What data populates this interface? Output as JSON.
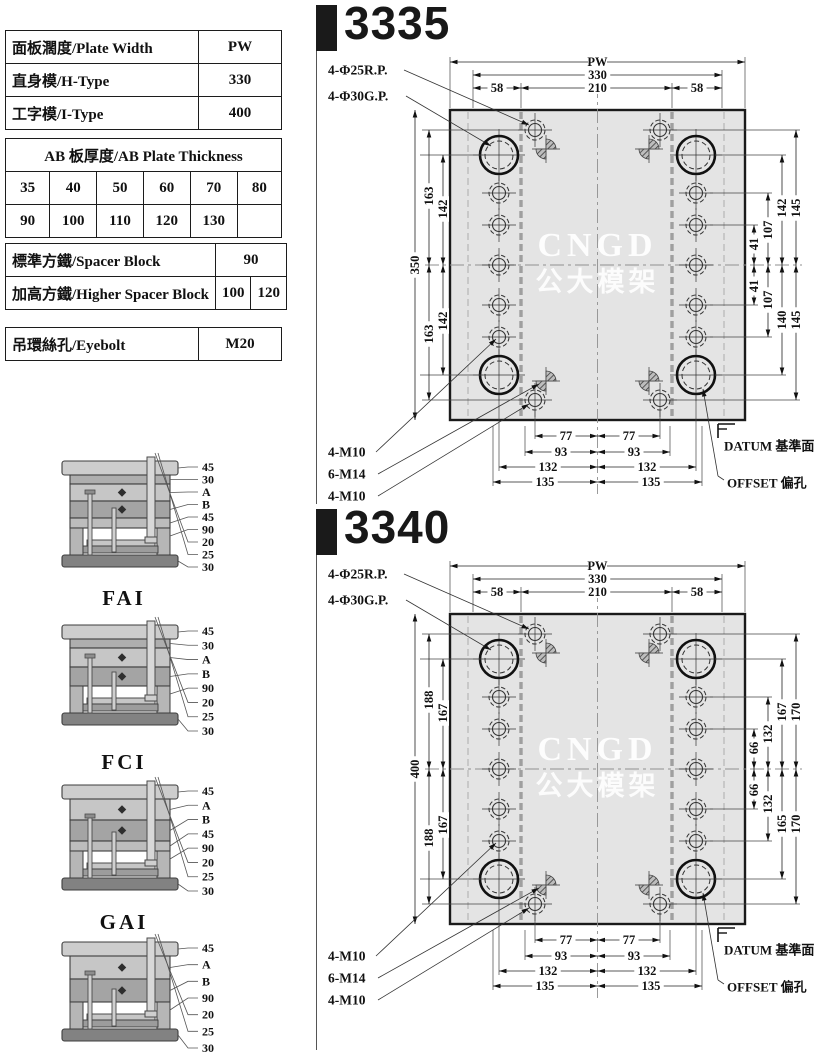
{
  "tables": {
    "plate_width": {
      "rows": [
        {
          "label": "面板濶度/Plate Width",
          "value": "PW"
        },
        {
          "label": "直身模/H-Type",
          "value": "330"
        },
        {
          "label": "工字模/I-Type",
          "value": "400"
        }
      ]
    },
    "ab_plate": {
      "header": "AB 板厚度/AB Plate Thickness",
      "rows": [
        [
          "35",
          "40",
          "50",
          "60",
          "70",
          "80"
        ],
        [
          "90",
          "100",
          "110",
          "120",
          "130",
          ""
        ]
      ]
    },
    "spacer": {
      "rows": [
        {
          "label": "標準方鐵/Spacer Block",
          "values": [
            "90"
          ]
        },
        {
          "label": "加高方鐵/Higher Spacer Block",
          "values": [
            "100",
            "120"
          ]
        }
      ]
    },
    "eyebolt": {
      "label": "吊環絲孔/Eyebolt",
      "value": "M20"
    }
  },
  "side_views": [
    {
      "name": "FAI",
      "labels": [
        "45",
        "30",
        "A",
        "B",
        "45",
        "90",
        "20",
        "25",
        "30"
      ]
    },
    {
      "name": "FCI",
      "labels": [
        "45",
        "30",
        "A",
        "B",
        "90",
        "20",
        "25",
        "30"
      ]
    },
    {
      "name": "GAI",
      "labels": [
        "45",
        "A",
        "B",
        "45",
        "90",
        "20",
        "25",
        "30"
      ]
    },
    {
      "name": "GCI",
      "labels": [
        "45",
        "A",
        "B",
        "90",
        "20",
        "25",
        "30"
      ]
    }
  ],
  "drawings": [
    {
      "model": "3335",
      "top": {
        "pw": "PW",
        "width": "330",
        "side_left": "58",
        "center": "210",
        "side_right": "58"
      },
      "left": {
        "overall": "350",
        "outer": "163",
        "inner": "142"
      },
      "right": {
        "q1": "41",
        "q2": "107",
        "top_inner": "142",
        "bottom_inner": "140",
        "outer_top": "145",
        "outer_bottom": "145"
      },
      "bottom": {
        "d1": "77",
        "d2": "93",
        "d3": "132",
        "d4": "135"
      },
      "callouts": {
        "rp": "4-Φ25R.P.",
        "gp": "4-Φ30G.P.",
        "m10a": "4-M10",
        "m14": "6-M14",
        "m10b": "4-M10",
        "datum": "DATUM 基準面",
        "offset": "OFFSET 偏孔"
      },
      "watermark": {
        "line1": "CNGD",
        "line2": "公大模架"
      }
    },
    {
      "model": "3340",
      "top": {
        "pw": "PW",
        "width": "330",
        "side_left": "58",
        "center": "210",
        "side_right": "58"
      },
      "left": {
        "overall": "400",
        "outer": "188",
        "inner": "167"
      },
      "right": {
        "q1": "66",
        "q2": "132",
        "top_inner": "167",
        "bottom_inner": "165",
        "outer_top": "170",
        "outer_bottom": "170"
      },
      "bottom": {
        "d1": "77",
        "d2": "93",
        "d3": "132",
        "d4": "135"
      },
      "callouts": {
        "rp": "4-Φ25R.P.",
        "gp": "4-Φ30G.P.",
        "m10a": "4-M10",
        "m14": "6-M14",
        "m10b": "4-M10",
        "datum": "DATUM 基準面",
        "offset": "OFFSET 偏孔"
      },
      "watermark": {
        "line1": "CNGD",
        "line2": "公大模架"
      }
    }
  ]
}
